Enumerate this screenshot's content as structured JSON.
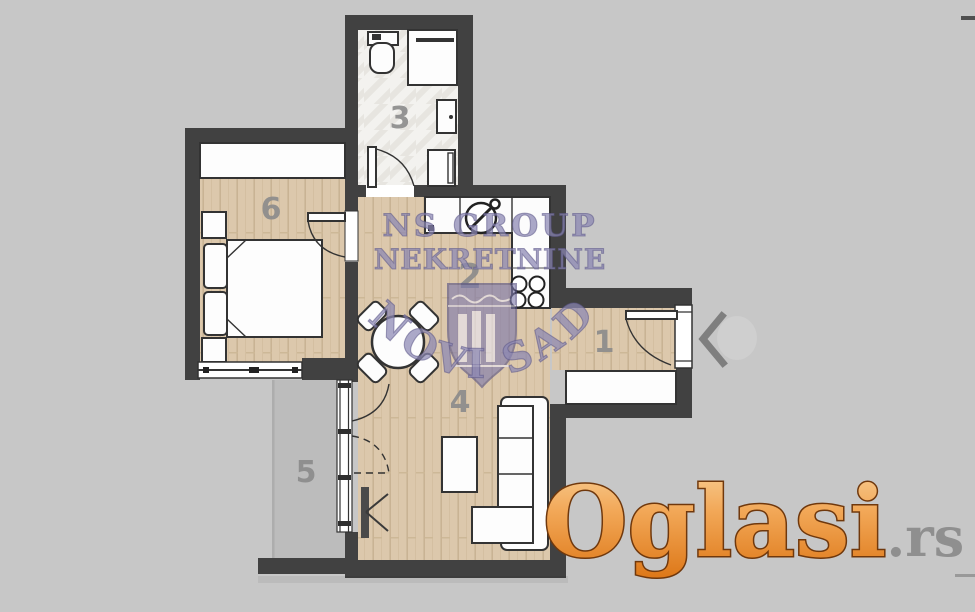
{
  "floorplan": {
    "room_numbers": {
      "hallway": "1",
      "kitchen": "2",
      "bathroom": "3",
      "living_room": "4",
      "terrace": "5",
      "bedroom": "6"
    }
  },
  "watermark": {
    "line1": "NS GROUP",
    "line2": "NEKRETNINE",
    "arc": "NOVI SAD"
  },
  "logo": {
    "brand": "Oglasi",
    "tld": ".rs"
  },
  "carousel": {
    "prev_icon": "chevron-left"
  },
  "colors": {
    "background": "#c7c7c7",
    "wall": "#414141",
    "wood_floor": "#dcc8ac",
    "tile_floor": "#f3f2ef",
    "terrace_floor": "#bcbcbc",
    "furniture": "#fdfdfd",
    "outline": "#333333",
    "room_number": "#8b8b8b",
    "watermark_purple": "#8b87b3",
    "logo_orange": "#ee9440",
    "logo_outline": "#70380c",
    "tld_gray": "#8f8f8f"
  }
}
